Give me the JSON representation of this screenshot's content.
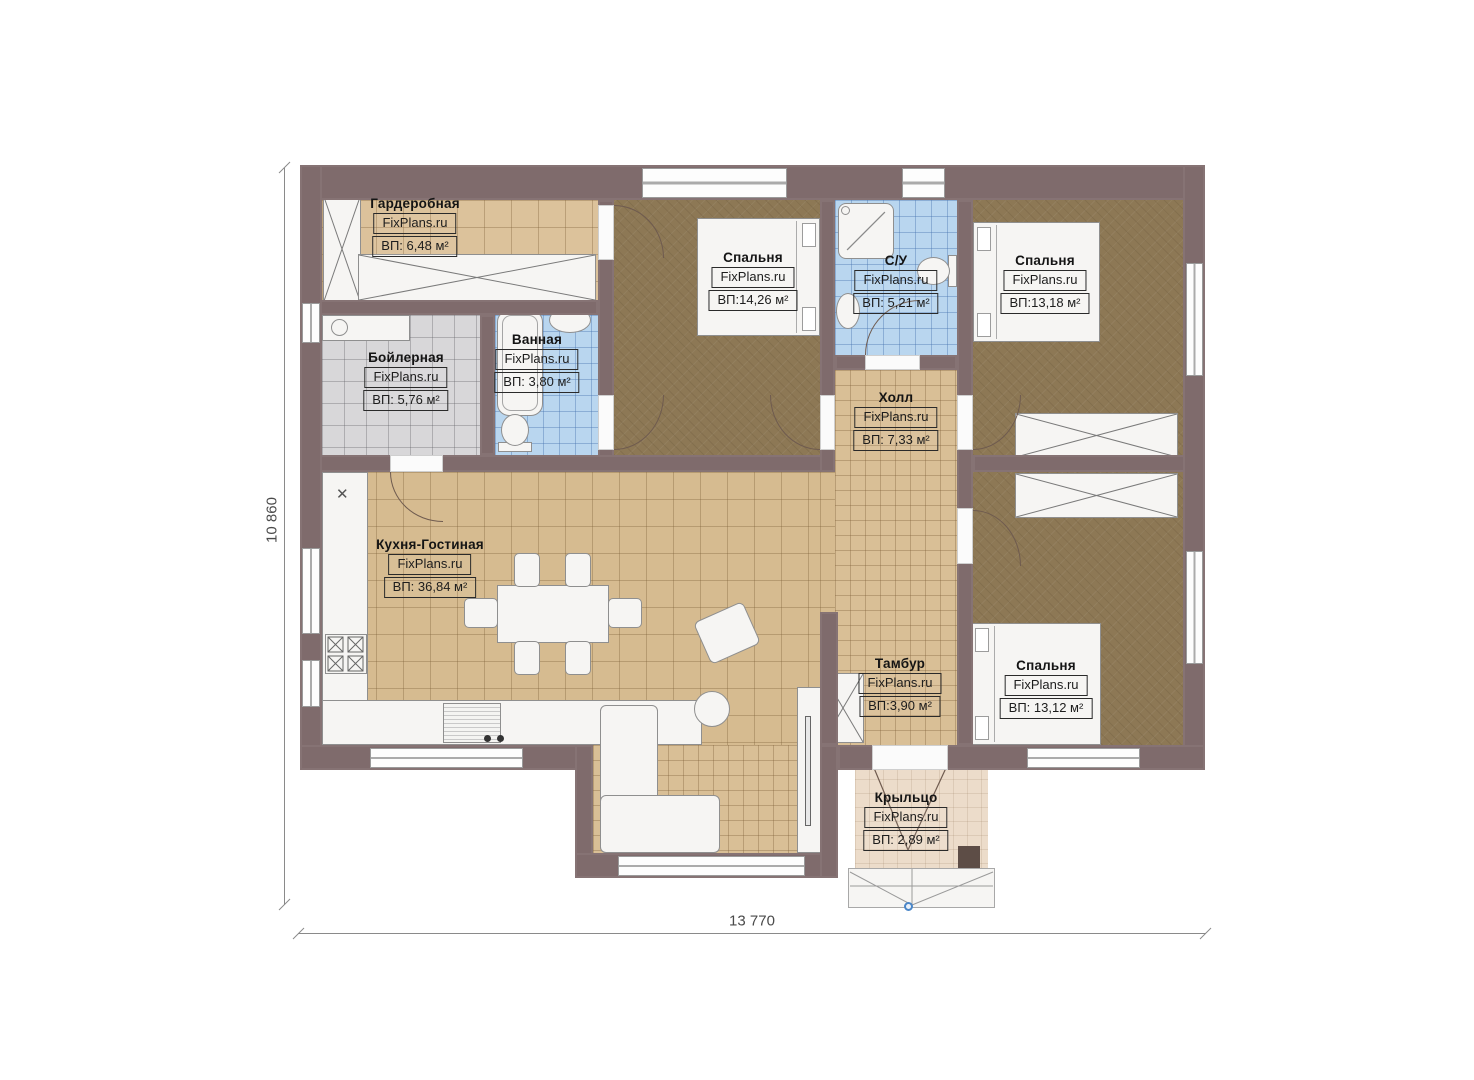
{
  "plan": {
    "brand": "FixPlans.ru",
    "dimensions": {
      "width_label": "13 770",
      "height_label": "10 860"
    },
    "colors": {
      "wall": "#7f6b6c",
      "floor_tile_tan": "#d6bb90",
      "floor_tile_tan_light": "#dcc29b",
      "floor_bedroom_brown": "#8d7855",
      "floor_tile_blue": "#b9d6ef",
      "floor_tile_gray": "#d8d7d9",
      "floor_porch": "#ecdcca",
      "furniture_white": "#f6f5f3",
      "entry_marker_blue": "#4a86c8"
    },
    "rooms": [
      {
        "id": "garderobnaya",
        "name": "Гардеробная",
        "watermark": "FixPlans.ru",
        "area": "ВП: 6,48 м²"
      },
      {
        "id": "boylernaya",
        "name": "Бойлерная",
        "watermark": "FixPlans.ru",
        "area": "ВП: 5,76 м²"
      },
      {
        "id": "vannaya",
        "name": "Ванная",
        "watermark": "FixPlans.ru",
        "area": "ВП: 3,80 м²"
      },
      {
        "id": "spalnya-1",
        "name": "Спальня",
        "watermark": "FixPlans.ru",
        "area": "ВП:14,26 м²"
      },
      {
        "id": "su",
        "name": "С/У",
        "watermark": "FixPlans.ru",
        "area": "ВП: 5,21 м²"
      },
      {
        "id": "spalnya-2",
        "name": "Спальня",
        "watermark": "FixPlans.ru",
        "area": "ВП:13,18 м²"
      },
      {
        "id": "holl",
        "name": "Холл",
        "watermark": "FixPlans.ru",
        "area": "ВП: 7,33 м²"
      },
      {
        "id": "kuhnya-gostinaya",
        "name": "Кухня-Гостиная",
        "watermark": "FixPlans.ru",
        "area": "ВП: 36,84 м²"
      },
      {
        "id": "tambur",
        "name": "Тамбур",
        "watermark": "FixPlans.ru",
        "area": "ВП:3,90 м²"
      },
      {
        "id": "spalnya-3",
        "name": "Спальня",
        "watermark": "FixPlans.ru",
        "area": "ВП: 13,12 м²"
      },
      {
        "id": "kryltso",
        "name": "Крыльцо",
        "watermark": "FixPlans.ru",
        "area": "ВП: 2,89 м²"
      }
    ],
    "symbols": {
      "kitchen_sink_mark": "✕"
    }
  }
}
